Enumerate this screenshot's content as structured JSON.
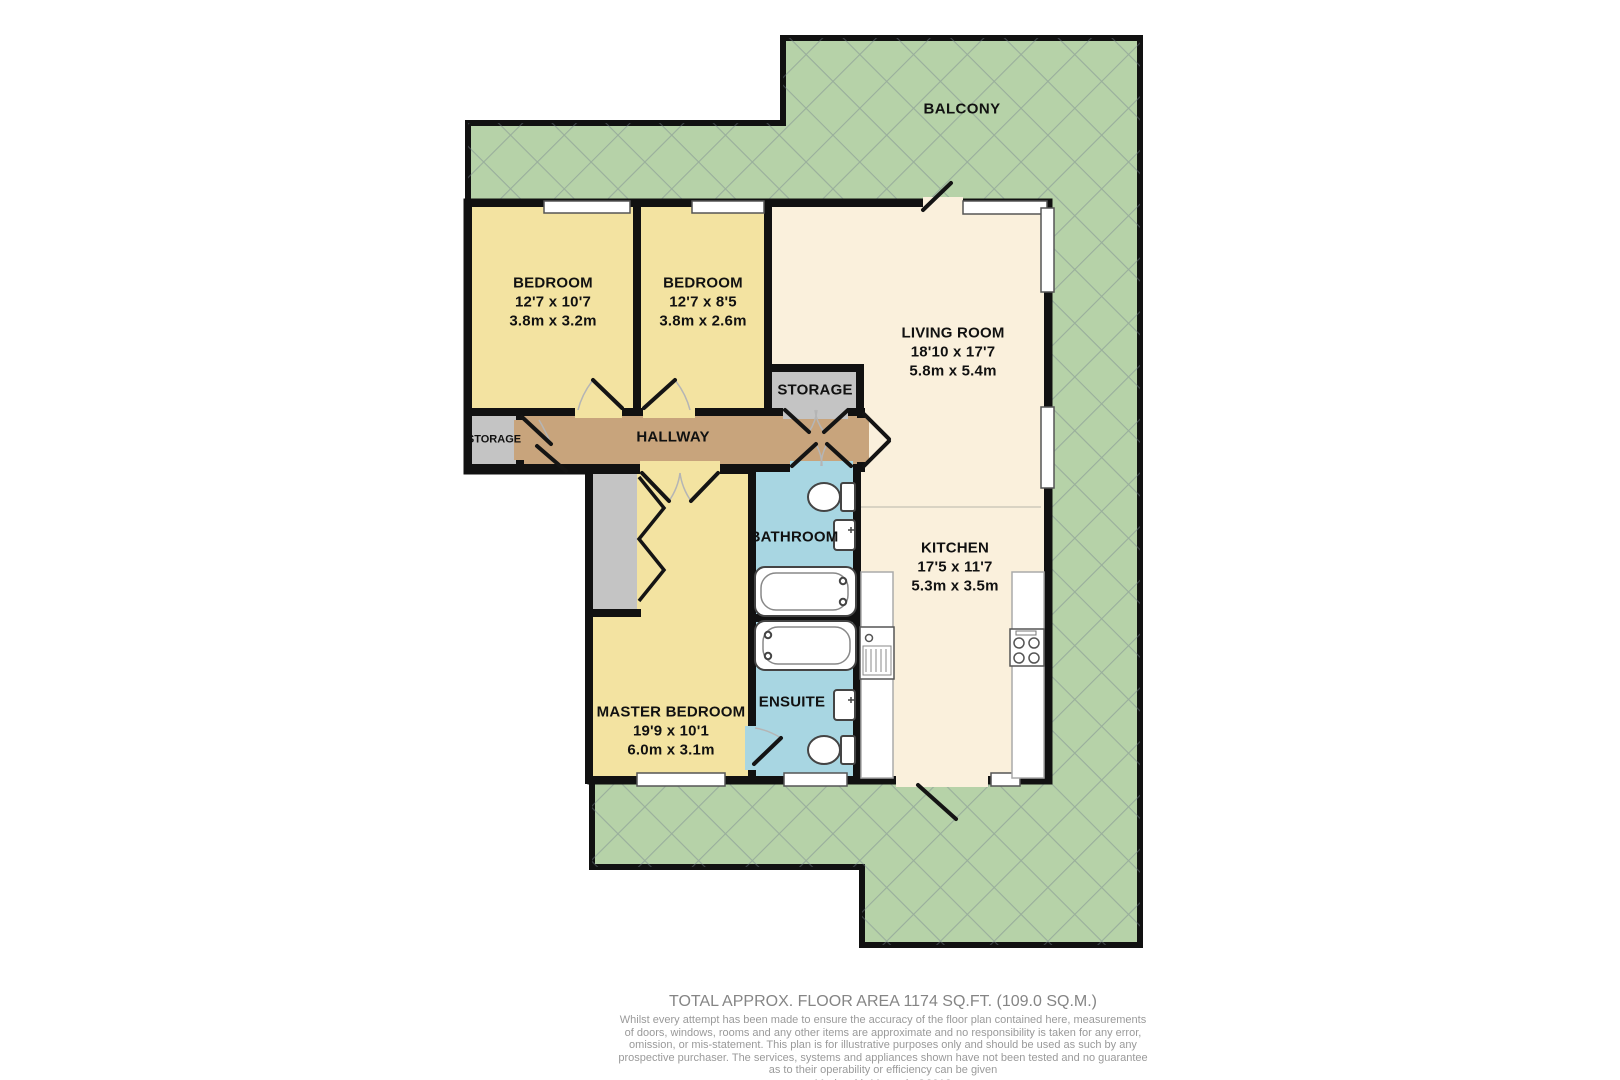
{
  "colors": {
    "wall": "#111111",
    "bedroom_fill": "#f3e3a1",
    "living_fill": "#faf0dc",
    "hallway_fill": "#c8a47c",
    "bath_fill": "#a8d6e2",
    "storage_fill": "#c4c4c4",
    "balcony_fill": "#b6d2a8",
    "balcony_lattice": "#76828f",
    "label_text": "#111111",
    "footer_text": "#8f8f8f"
  },
  "balcony": {
    "label": "BALCONY"
  },
  "rooms": {
    "bedroom1": {
      "name": "BEDROOM",
      "imperial": "12'7 x 10'7",
      "metric": "3.8m x 3.2m"
    },
    "bedroom2": {
      "name": "BEDROOM",
      "imperial": "12'7 x 8'5",
      "metric": "3.8m x 2.6m"
    },
    "living_room": {
      "name": "LIVING ROOM",
      "imperial": "18'10 x 17'7",
      "metric": "5.8m x 5.4m"
    },
    "kitchen": {
      "name": "KITCHEN",
      "imperial": "17'5 x 11'7",
      "metric": "5.3m x 3.5m"
    },
    "master_bedroom": {
      "name": "MASTER BEDROOM",
      "imperial": "19'9 x 10'1",
      "metric": "6.0m x 3.1m"
    },
    "hallway": {
      "name": "HALLWAY"
    },
    "bathroom": {
      "name": "BATHROOM"
    },
    "ensuite": {
      "name": "ENSUITE"
    },
    "storage_main": {
      "name": "STORAGE"
    },
    "storage_small": {
      "name": "STORAGE"
    }
  },
  "footer": {
    "total_area": "TOTAL APPROX. FLOOR AREA 1174 SQ.FT. (109.0 SQ.M.)",
    "disclaimer_lines": [
      "Whilst every attempt has been made to ensure the accuracy of the floor plan contained here, measurements",
      "of doors, windows, rooms and any other items are approximate and no responsibility is taken for any error,",
      "omission, or mis-statement. This plan is for illustrative purposes only and should be used as such by any",
      "prospective purchaser. The services, systems and appliances shown have not been tested and no guarantee",
      "as to their operability or efficiency can be given"
    ],
    "credit": "Made with Metropix ©2018"
  }
}
